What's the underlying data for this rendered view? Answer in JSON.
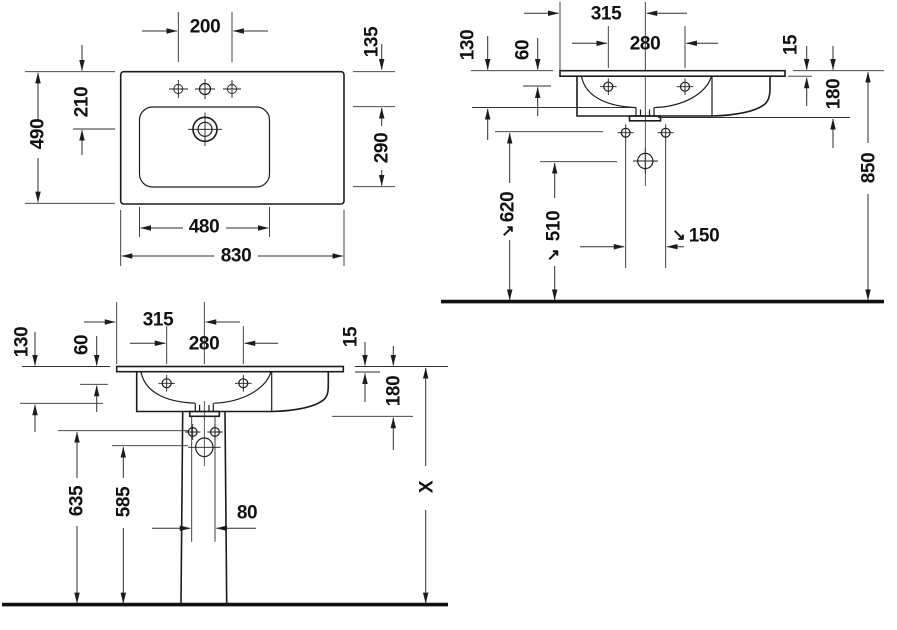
{
  "views": {
    "plan": {
      "dims": {
        "faucet_centers": "200",
        "rim_to_basin": "135",
        "overall_depth": "490",
        "rim_to_drain": "210",
        "basin_depth": "290",
        "basin_width": "480",
        "overall_width": "830"
      }
    },
    "wall_mount": {
      "dims": {
        "edge_to_drain": "315",
        "fixing_centers": "280",
        "rim_to_bowl": "130",
        "rim_to_fixing": "60",
        "rim_thickness": "15",
        "front_height": "180",
        "fixing_height": "620",
        "outlet_height": "510",
        "outlet_centers": "150",
        "rim_height": "850"
      }
    },
    "pedestal": {
      "dims": {
        "edge_to_drain": "315",
        "fixing_centers": "280",
        "rim_to_bowl": "130",
        "rim_to_fixing": "60",
        "rim_thickness": "15",
        "front_height": "180",
        "pedestal_fixing_height": "635",
        "siphon_height": "585",
        "cutout_width": "80",
        "variable_height": "X"
      }
    }
  },
  "icons": {
    "ref_arrow_ne": "↗",
    "ref_arrow_se": "↘"
  }
}
